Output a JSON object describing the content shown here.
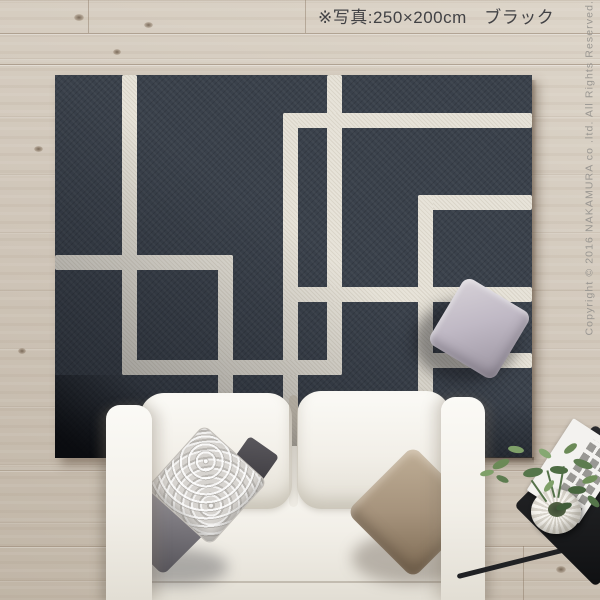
{
  "caption": {
    "text": "※写真:250×200cm　ブラック"
  },
  "product": {
    "size": "250×200cm",
    "color_name": "ブラック"
  },
  "copyright": {
    "text": "Copyright © 2016 NAKAMURA co .ltd. All Rights Reserved."
  },
  "palette": {
    "floor": "#cfc5b8",
    "floor_light": "#ddd5c9",
    "floor_dark": "#c0b5a6",
    "rug": "#3a414b",
    "rug_line": "#e7e3d9",
    "sofa": "#f2efe8",
    "sofa_shade": "#e2ded4",
    "pillow_dark": "#7a777d",
    "pillow_damask": "#d7d4d0",
    "pillow_taupe": "#a6937c",
    "pillow_lav": "#c0b9c5",
    "table_black": "#1b1c1e",
    "pot": "#f7f5f0",
    "magazine": "#f3f2ef",
    "plant_green": "#5d7c50",
    "text_caption": "#424245",
    "text_copyright": "#9a9792"
  }
}
